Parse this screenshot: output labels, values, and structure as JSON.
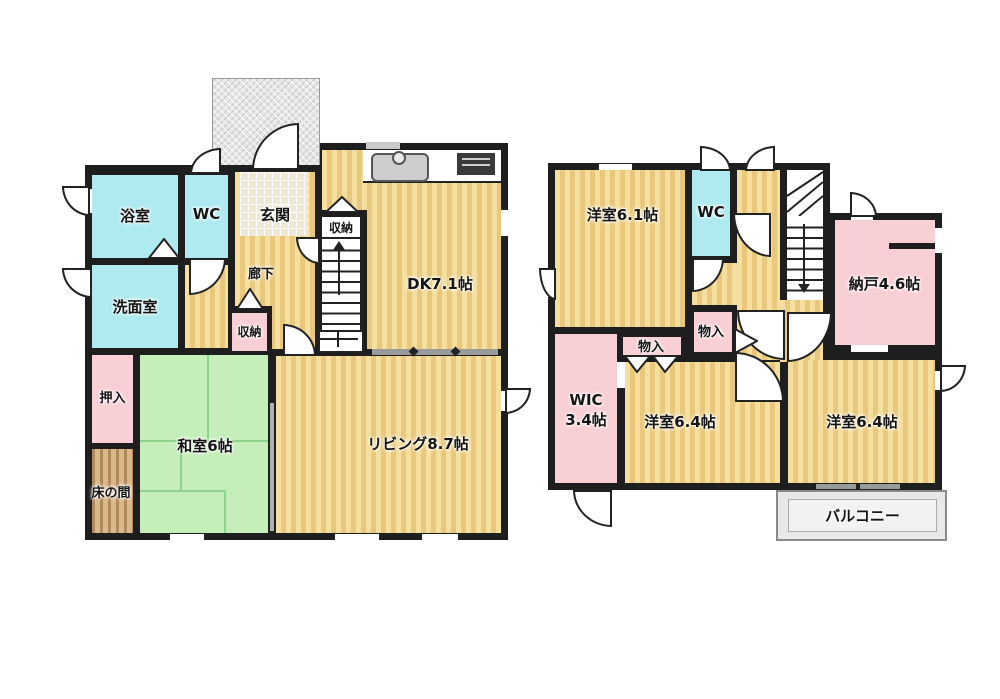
{
  "floor1": {
    "rooms": {
      "bath": "浴室",
      "wc": "WC",
      "entrance": "玄関",
      "hallway": "廊下",
      "stair_storage": "収納",
      "dk": "DK7.1帖",
      "washroom": "洗面室",
      "closet": "収納",
      "oshiire": "押入",
      "washitsu": "和室6帖",
      "tokonoma": "床の間",
      "living": "リビング8.7帖"
    }
  },
  "floor2": {
    "rooms": {
      "bedroom1": "洋室6.1帖",
      "wc": "WC",
      "nando": "納戸4.6帖",
      "storage_left": "物入",
      "storage_mid": "物入",
      "wic_line1": "WIC",
      "wic_line2": "3.4帖",
      "bedroom2": "洋室6.4帖",
      "bedroom3": "洋室6.4帖",
      "balcony": "バルコニー"
    }
  },
  "colors": {
    "wall": "#1e1e1e",
    "floor_light": "#f4df9f",
    "floor_stripe": "#e9c87d",
    "water_rooms": "#aeeaf0",
    "storage_pink": "#f9cfd6",
    "tatami_green": "#c6eebb",
    "tokonoma_wood": "#b08a5d",
    "porch_gray": "#e6e6e6",
    "balcony_gray": "#e8e8e8"
  }
}
